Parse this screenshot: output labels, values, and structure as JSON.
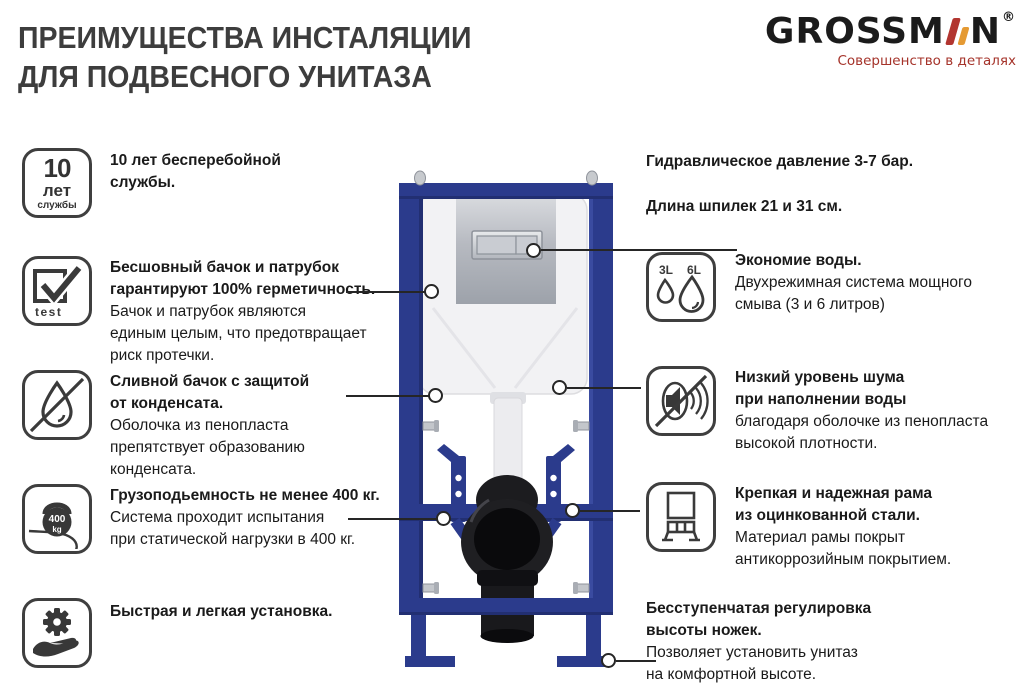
{
  "title": {
    "line1": "ПРЕИМУЩЕСТВА ИНСТАЛЯЦИИ",
    "line2": "ДЛЯ ПОДВЕСНОГО УНИТАЗА"
  },
  "logo": {
    "text_start": "GROSSM",
    "text_end": "N",
    "registered_mark": "®",
    "tagline": "Совершенство в деталях"
  },
  "colors": {
    "frame_blue": "#2b3b8c",
    "frame_blue_dark": "#222f72",
    "logo_bar_red": "#b23530",
    "logo_bar_orange": "#e59a33",
    "tagline_red": "#a5332a",
    "icon_stroke": "#3a3a3a",
    "chrome": "#b7bac1",
    "pipe_black": "#1c1c1f"
  },
  "specs": [
    {
      "text": "Гидравлическое давление 3-7 бар."
    },
    {
      "text": "Длина шпилек 21 и 31 см."
    }
  ],
  "left_features": [
    {
      "icon": "10-years-badge-icon",
      "icon_labels": {
        "line1": "10",
        "line2": "лет",
        "line3": "службы"
      },
      "heading_lines": [
        "10 лет бесперебойной",
        "службы."
      ],
      "body_lines": []
    },
    {
      "icon": "tested-checkmark-icon",
      "icon_labels": {
        "caption": "test"
      },
      "heading_lines": [
        "Бесшовный бачок и патрубок",
        "гарантируют 100% герметичность."
      ],
      "body_lines": [
        "Бачок и патрубок являются",
        "единым целым, что предотвращает",
        "риск протечки."
      ]
    },
    {
      "icon": "no-condensation-drop-icon",
      "heading_lines": [
        "Сливной бачок с защитой",
        "от конденсата."
      ],
      "body_lines": [
        "Оболочка из пенопласта",
        "препятствует образованию",
        "конденсата."
      ]
    },
    {
      "icon": "kettlebell-400kg-icon",
      "icon_labels": {
        "value": "400",
        "unit": "kg"
      },
      "heading_lines": [
        "Грузоподьемность не менее 400 кг."
      ],
      "body_lines": [
        "Система проходит испытания",
        "при статической нагрузки в 400 кг."
      ]
    },
    {
      "icon": "easy-install-hand-gear-icon",
      "heading_lines": [
        "Быстрая и легкая установка."
      ],
      "body_lines": []
    }
  ],
  "right_features": [
    {
      "icon": "dual-flush-drops-icon",
      "icon_labels": {
        "small": "3L",
        "large": "6L"
      },
      "heading_lines": [
        "Экономие воды."
      ],
      "body_lines": [
        "Двухрежимная система мощного",
        "смыва (3 и 6 литров)"
      ]
    },
    {
      "icon": "no-noise-speaker-icon",
      "heading_lines": [
        "Низкий уровень шума",
        "при наполнении воды"
      ],
      "body_lines": [
        "благодаря оболочке из пенопласта",
        "высокой плотности."
      ]
    },
    {
      "icon": "steel-frame-icon",
      "heading_lines": [
        "Крепкая и надежная рама",
        "из оцинкованной стали."
      ],
      "body_lines": [
        "Материал рамы покрыт",
        "антикоррозийным покрытием."
      ]
    },
    {
      "heading_lines": [
        "Бесступенчатая регулировка",
        "высоты ножек."
      ],
      "body_lines": [
        "Позволяет установить унитаз",
        "на комфортной высоте."
      ]
    }
  ],
  "illustration": {
    "description": "Концелед — настенная инсталляция для подвесного унитаза: синяя стальная рама, белый бачок, хромированная кнопка двойного смыва, черный выпускной патрубок"
  }
}
